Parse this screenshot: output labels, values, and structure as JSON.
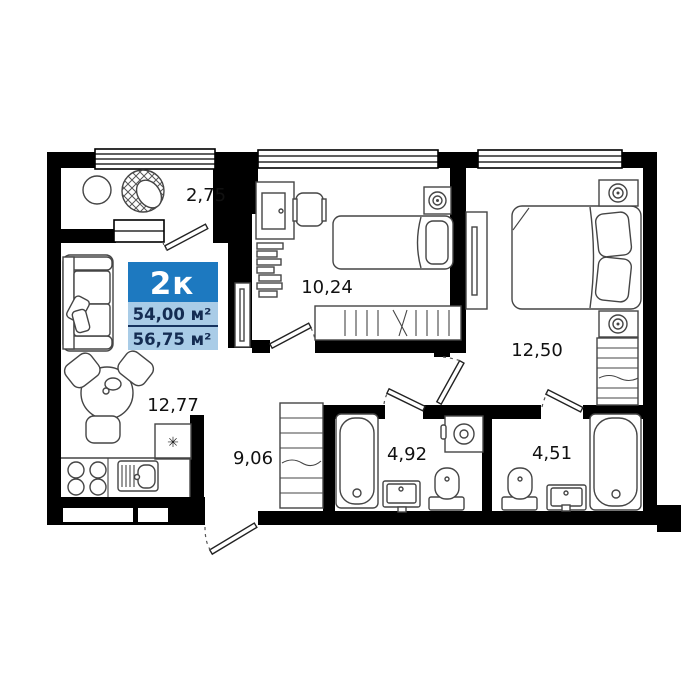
{
  "badge": {
    "rooms_label": "2к",
    "area_total": "54,00 м²",
    "area_full": "56,75 м²"
  },
  "rooms": [
    {
      "id": "balcony",
      "area": "2,75",
      "furniture": [
        "round-table",
        "wicker-chair"
      ]
    },
    {
      "id": "bedroom-small",
      "area": "10,24",
      "furniture": [
        "desk",
        "monitor",
        "office-chair",
        "bookshelf",
        "single-bed",
        "nightstand-lamp",
        "wardrobe"
      ]
    },
    {
      "id": "bedroom-master",
      "area": "12,50",
      "furniture": [
        "tv-stand",
        "double-bed",
        "nightstand-lamp",
        "nightstand-lamp",
        "shelving-wardrobe"
      ]
    },
    {
      "id": "living-kitchen",
      "area": "12,77",
      "furniture": [
        "sofa",
        "tv",
        "dining-table",
        "chair",
        "chair",
        "chair",
        "fridge",
        "stove",
        "kitchen-sink",
        "counter"
      ]
    },
    {
      "id": "hallway",
      "area": "9,06",
      "furniture": [
        "closet"
      ]
    },
    {
      "id": "bathroom-1",
      "area": "4,92",
      "furniture": [
        "bathtub",
        "washing-machine",
        "sink",
        "toilet"
      ]
    },
    {
      "id": "bathroom-2",
      "area": "4,51",
      "furniture": [
        "toilet",
        "sink",
        "bathtub"
      ]
    }
  ],
  "symbols": {
    "fridge_snowflake": "✳"
  },
  "colors": {
    "badge_accent": "#1d79c0",
    "badge_light": "#a9cce7",
    "badge_divider": "#16335f",
    "badge_text": "#142c52",
    "wall": "#000000"
  }
}
